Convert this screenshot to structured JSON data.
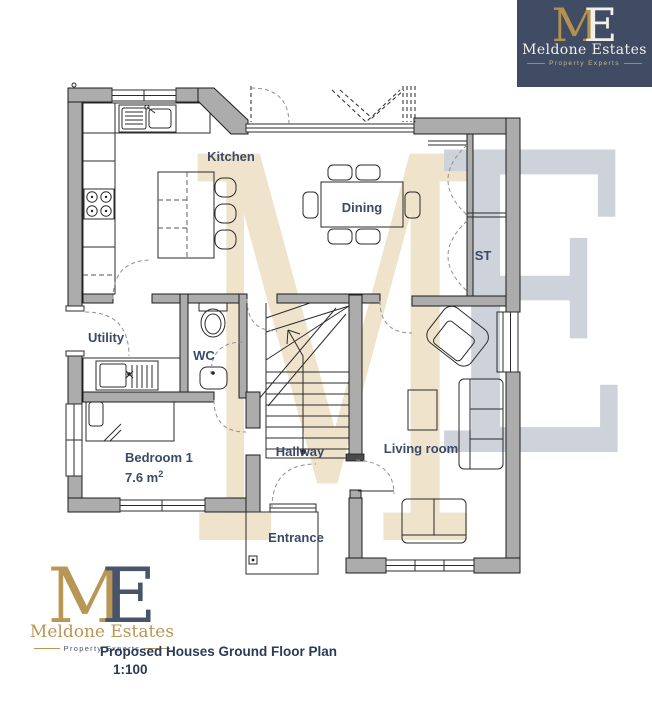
{
  "page": {
    "width": 652,
    "height": 720,
    "background": "#ffffff"
  },
  "title_block": {
    "line1": "Proposed Houses Ground Floor Plan",
    "scale": "1:100"
  },
  "brand": {
    "monogram": {
      "m": "M",
      "e": "E"
    },
    "name": "Meldone Estates",
    "tagline": "Property Experts",
    "colors": {
      "navy": "#3f4c63",
      "gold": "#b5914e",
      "cream": "#f1efe9"
    }
  },
  "watermark": {
    "m": "M",
    "e": "E",
    "m_color": "#efe3cb",
    "e_color": "#cdd2db"
  },
  "plan": {
    "colors": {
      "wall": "#acacac",
      "line": "#2b2b2b",
      "door_arc": "#8f8f8f",
      "label": "#3b4a68"
    },
    "rooms": {
      "kitchen": {
        "label": "Kitchen"
      },
      "dining": {
        "label": "Dining"
      },
      "storage": {
        "label": "ST"
      },
      "utility": {
        "label": "Utility"
      },
      "wc": {
        "label": "WC"
      },
      "bedroom1": {
        "label": "Bedroom 1",
        "area": "7.6 m",
        "area_sup": "2"
      },
      "hallway": {
        "label": "Hallway"
      },
      "living": {
        "label": "Living room"
      },
      "entrance": {
        "label": "Entrance"
      }
    }
  }
}
